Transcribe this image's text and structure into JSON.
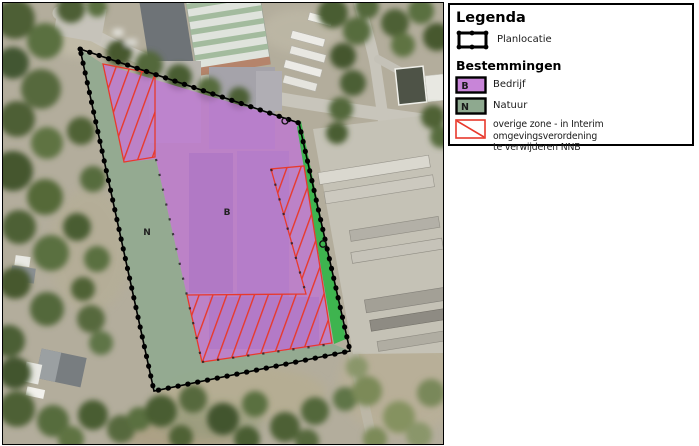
{
  "legend": {
    "title": "Legenda",
    "planlocatie_label": "Planlocatie",
    "section_title": "Bestemmingen",
    "bedrijf": {
      "code": "B",
      "label": "Bedrijf",
      "color": "#c885d8"
    },
    "natuur": {
      "code": "N",
      "label": "Natuur",
      "color": "#8ea98f"
    },
    "overige": {
      "line1": "overige zone - in Interim omgevingsverordening",
      "line2": "te verwijderen NNB",
      "color": "#e8392c"
    }
  },
  "map": {
    "bedrijf_label": "B",
    "natuur_label": "N",
    "bedrijf_fill": "#bf72d8",
    "natuur_fill": "#8ea98f",
    "natuur_strip_fill": "#38b44b",
    "hatch_color": "#e8392c",
    "boundary_color": "#000000"
  }
}
